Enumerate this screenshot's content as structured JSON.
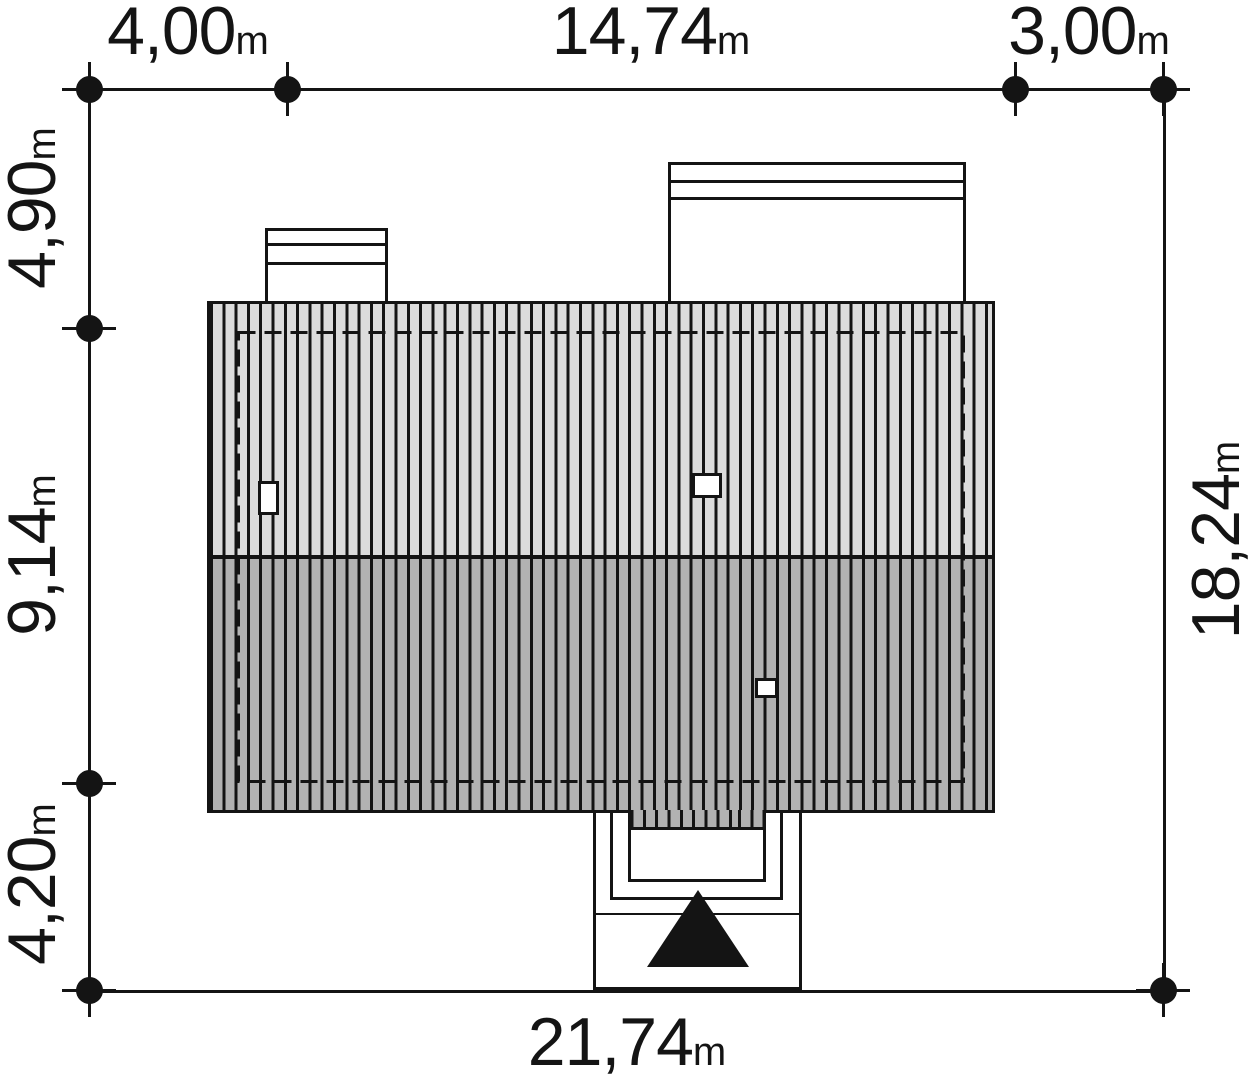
{
  "plan": {
    "type": "architectural-site-plan-roof-view",
    "colors": {
      "background": "#ffffff",
      "line": "#141414",
      "roof_light": "#dcdcdc",
      "roof_dark": "#b2b2b2",
      "marker": "#141414"
    },
    "dimensions": {
      "top": [
        {
          "value": "4,00",
          "unit": "m"
        },
        {
          "value": "14,74",
          "unit": "m"
        },
        {
          "value": "3,00",
          "unit": "m"
        }
      ],
      "left": [
        {
          "value": "4,90",
          "unit": "m"
        },
        {
          "value": "9,14",
          "unit": "m"
        },
        {
          "value": "4,20",
          "unit": "m"
        }
      ],
      "right": [
        {
          "value": "18,24",
          "unit": "m"
        }
      ],
      "bottom": [
        {
          "value": "21,74",
          "unit": "m"
        }
      ]
    }
  }
}
